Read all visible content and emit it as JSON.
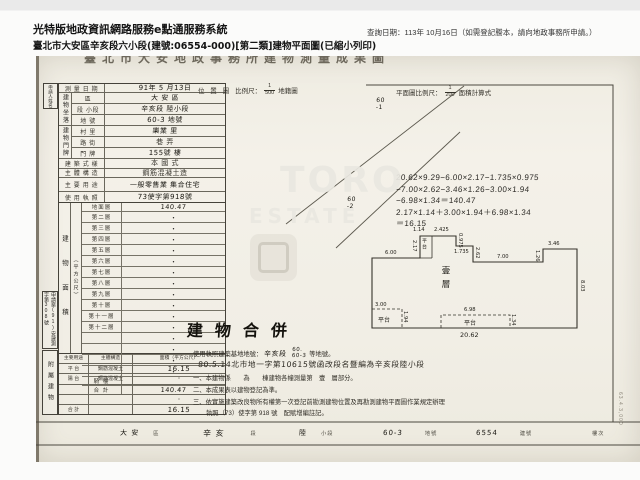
{
  "header": {
    "app_title": "光特版地政資訊網路服務e點通服務系統",
    "query_date": "查詢日期：113年 10月16日（如需登記謄本，請向地政事務所申請。）",
    "doc_title": "臺北市大安區辛亥段六小段(建號:06554-000)[第二類]建物平面圖(已縮小列印)"
  },
  "scan": {
    "form_title": "臺北市大安地政事務所建物測量成果圖",
    "applicant_box": "申請人姓名",
    "case_box": "申請案(91)安建測字第308號",
    "annex_box": "附屬建物",
    "survey": {
      "label": "測 量 日 期",
      "value": "91年 5 月13日"
    },
    "site": {
      "group": "建物坐落",
      "rows": [
        {
          "label": "區",
          "value": "大 安 區"
        },
        {
          "label": "段 小段",
          "value": "辛亥段 陸小段"
        },
        {
          "label": "地 號",
          "value": "60-3 地號"
        }
      ]
    },
    "door": {
      "group": "建物門牌",
      "rows": [
        {
          "label": "村 里",
          "value": "樂業 里"
        },
        {
          "label": "路 街",
          "value": "巷 弄"
        },
        {
          "label": "門 牌",
          "value": "155號 樓"
        }
      ]
    },
    "style_row": {
      "label": "建 築 式 樣",
      "value": "本 國 式"
    },
    "structure_row": {
      "label": "主 體 構 造",
      "value": "鋼筋混凝土造"
    },
    "usage_row": {
      "label": "主 要 用 途",
      "value": "一般零售業 集合住宅"
    },
    "license_row": {
      "label": "使 用 執 照",
      "value": "73使字第918號"
    },
    "area_section": {
      "group": "建物面積",
      "unit": "（平方公尺）",
      "rows": [
        {
          "label": "地面層",
          "value": "140.47"
        },
        {
          "label": "第二層",
          "value": "・"
        },
        {
          "label": "第三層",
          "value": "・"
        },
        {
          "label": "第四層",
          "value": "・"
        },
        {
          "label": "第五層",
          "value": "・"
        },
        {
          "label": "第六層",
          "value": "・"
        },
        {
          "label": "第七層",
          "value": "・"
        },
        {
          "label": "第八層",
          "value": "・"
        },
        {
          "label": "第九層",
          "value": "・"
        },
        {
          "label": "第十層",
          "value": "・"
        },
        {
          "label": "第十一層",
          "value": "・"
        },
        {
          "label": "第十二層",
          "value": "・"
        },
        {
          "label": "",
          "value": "・"
        },
        {
          "label": "",
          "value": "・"
        },
        {
          "label": "",
          "value": "・"
        },
        {
          "label": "",
          "value": "・"
        },
        {
          "label": "騎 樓",
          "value": ""
        },
        {
          "label": "合 計",
          "value": "140.47"
        }
      ]
    },
    "annex_section": {
      "headers": [
        "主要用途",
        "主體構造",
        "面積（平方公尺）"
      ],
      "rows": [
        [
          "平 台",
          "鋼筋混凝土",
          "16.15"
        ],
        [
          "陽 台",
          "鋼筋混凝土",
          "・"
        ],
        [
          "",
          "",
          "・"
        ],
        [
          "",
          "",
          "・"
        ],
        [
          "合 計",
          "",
          "16.15"
        ]
      ]
    },
    "location": {
      "label": "位 置 圖",
      "scale_prefix": "比例尺：",
      "num": "1",
      "den": "500",
      "suffix": "地籍圖"
    },
    "plan_scale": {
      "prefix": "平面圖比例尺：",
      "num": "1",
      "den": "200",
      "suffix": "面積計算式"
    },
    "parcels": {
      "p1_top": "60",
      "p1_bottom": "-1",
      "p2_top": "60",
      "p2_bottom": "-2"
    },
    "calc_lines": [
      "20.62×9.29−6.00×2.17−1.735×0.975",
      "−7.00×2.62−3.46×1.26−3.00×1.94",
      "−6.98×1.34＝140.47",
      "2.17×1.14＋3.00×1.94＋6.98×1.34",
      "＝16.15"
    ],
    "plan": {
      "floor_label": "壹層",
      "dims": {
        "top_small": "1.14",
        "top_left": "2.425",
        "platform_h": "2.17",
        "platform": "平台",
        "notch_d": "0.975",
        "notch_w": "1.735",
        "mid_d": "2.62",
        "mid_w": "7.00",
        "right_w": "3.46",
        "right_d": "1.26",
        "right_h": "8.03",
        "left_w": "6.00",
        "p1_w": "3.00",
        "p1": "平台",
        "p1_h": "1.94",
        "p2_w": "6.98",
        "p2": "平台",
        "p2_h": "1.34",
        "bottom_w": "20.62"
      }
    },
    "notes": {
      "merge_title": "建物合併",
      "line1_prefix": "使用執照建築基地地號：",
      "line1_hw": "辛亥段",
      "line1_no_top": "60.",
      "line1_no_bottom": "60-3",
      "line1_suffix": "等地號。",
      "line2": "80.5.14北市地一字第10615號函改段名暨編為辛亥段陸小段",
      "note1": "一、本建物係　　為　　棟建物各幢測量第　壹　層部分。",
      "note2": "二、本成果表以建物登記為準。",
      "note3": "三、依實施建築改良物所有權第一次登記前勘測建物位置及再勘測建物平面圖作業規定辦理",
      "note3b": "執照（73）使字第 918 號　配賦增編註記。"
    },
    "footer": {
      "items": [
        {
          "hw": "大 安",
          "p": "區"
        },
        {
          "hw": "辛 亥",
          "p": "段"
        },
        {
          "hw": "陸",
          "p": "小段"
        },
        {
          "hw": "60-3",
          "p": "地號"
        },
        {
          "hw": "6554",
          "p": "建號"
        },
        {
          "hw": "",
          "p": "樓次"
        }
      ]
    },
    "print_code": "63.4.3,000",
    "watermark": {
      "line1": "TORO",
      "line2": "ESTATE"
    }
  }
}
